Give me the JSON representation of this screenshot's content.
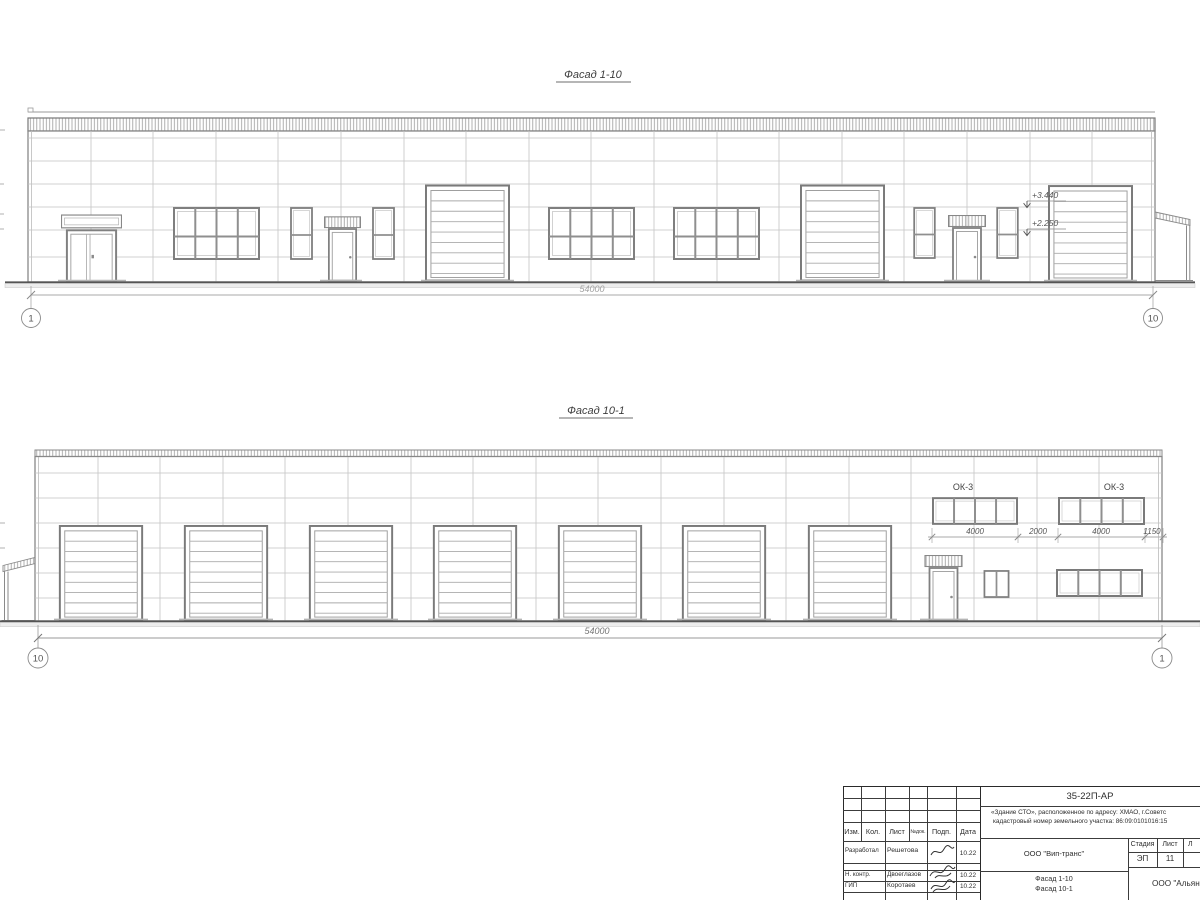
{
  "colors": {
    "background": "#ffffff",
    "line_dark": "#555555",
    "line_mid": "#888888",
    "line_light": "#c0c0c0",
    "dim_light": "#a2a2a2",
    "titleblock_line": "#3c3c3c",
    "text": "#2e2e2e"
  },
  "facade1": {
    "title": "Фасад 1-10",
    "elevations": {
      "upper": "+3.440",
      "lower": "+2.250"
    },
    "dimension_total": "54000",
    "axis_left": "1",
    "axis_right": "10"
  },
  "facade2": {
    "title": "Фасад 10-1",
    "window_labels": {
      "left": "ОК-3",
      "right": "ОК-3"
    },
    "dims": {
      "d1": "4000",
      "d2": "2000",
      "d3": "4000",
      "d4": "1150"
    },
    "dimension_total": "54000",
    "axis_left": "10",
    "axis_right": "1"
  },
  "title_block": {
    "doc_number": "35-22П-АР",
    "address_line1": "«Здание СТО», расположенное по адресу: ХМАО, г.Советс",
    "address_line2": "кадастровый номер земельного участка: 86:09:0101016:15",
    "header": {
      "izm": "Изм.",
      "kol": "Кол.",
      "list": "Лист",
      "ndok": "№док.",
      "podp": "Подп.",
      "data": "Дата"
    },
    "rows": [
      {
        "role": "Разработал",
        "name": "Решетова",
        "date": "10.22"
      },
      {
        "role": "Н. контр.",
        "name": "Двоеглазов",
        "date": "10.22"
      },
      {
        "role": "ГИП",
        "name": "Коротаев",
        "date": "10.22"
      }
    ],
    "company": "ООО \"Вип-транс\"",
    "sheet_name_line1": "Фасад 1-10",
    "sheet_name_line2": "Фасад 10-1",
    "stage_header": "Стадия",
    "sheet_header": "Лист",
    "sheets_header": "Л",
    "stage_value": "ЭП",
    "sheet_value": "11",
    "org": "ООО \"Альян"
  }
}
